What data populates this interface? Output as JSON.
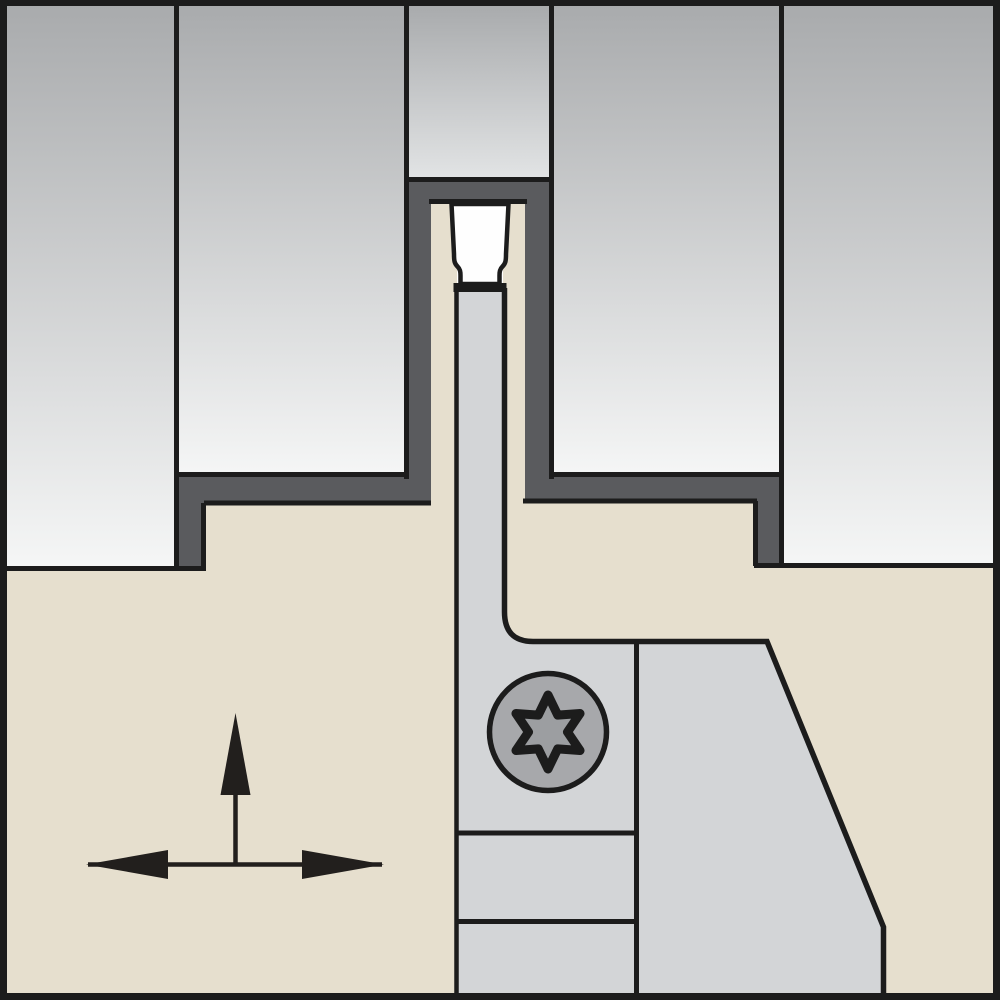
{
  "diagram": {
    "type": "tool-cross-section-illustration",
    "icons": {
      "screw": "torx-screw-icon",
      "movement": "direction-arrows-icon"
    }
  },
  "colors": {
    "background": "#ffffff",
    "outline": "#1c1c1c",
    "workpiece_top": "#a9abad",
    "workpiece_bottom": "#f5f6f6",
    "workpiece_short_bottom": "#e2e4e5",
    "slot_dark": "#5a5b5e",
    "holder_tan": "#e6dfce",
    "blade_gray": "#d3d5d7",
    "insert_white": "#fefefe",
    "screw_head": "#a7a8ab",
    "screw_star": "#9c9ea1",
    "arrow_black": "#221f1d"
  }
}
